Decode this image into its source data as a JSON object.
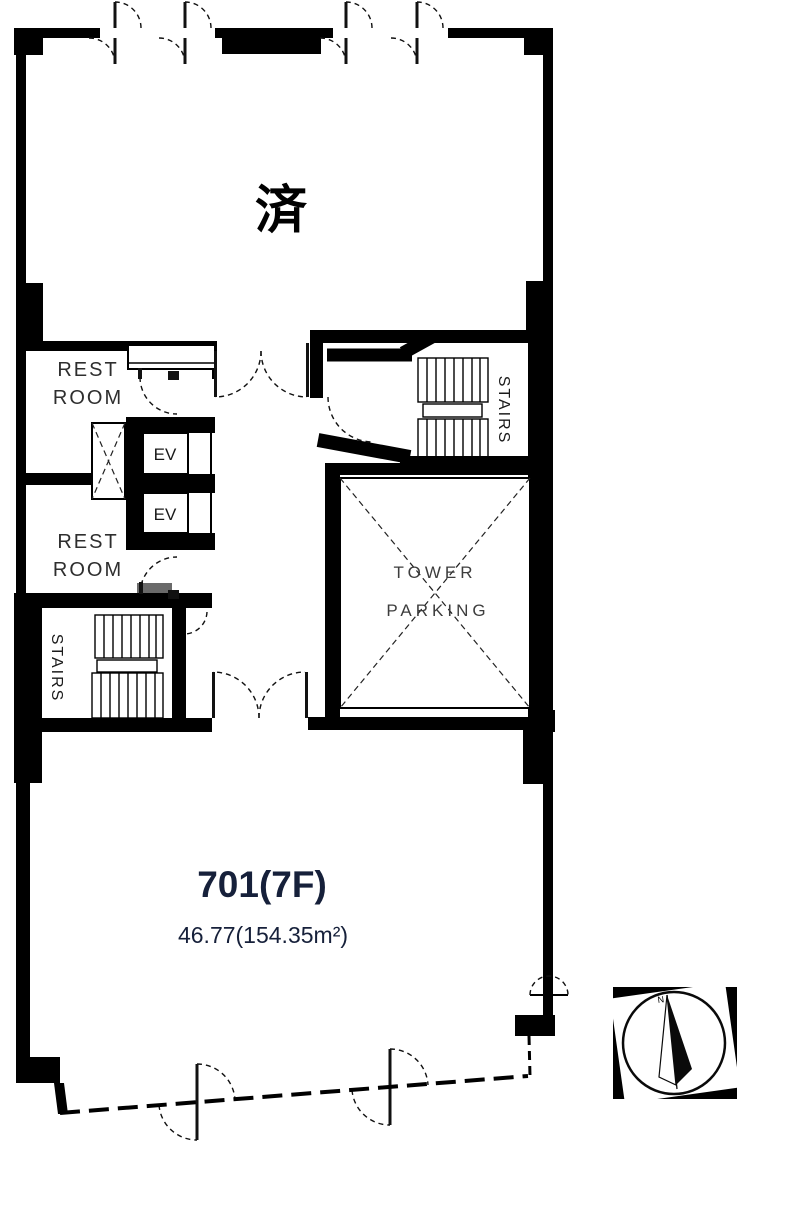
{
  "status": {
    "label": "済"
  },
  "unit": {
    "number": "701(7F)",
    "area": "46.77(154.35m²)"
  },
  "rooms": {
    "restroom_upper": {
      "line1": "REST",
      "line2": "ROOM"
    },
    "restroom_lower": {
      "line1": "REST",
      "line2": "ROOM"
    },
    "stairs_left": {
      "label": "STAIRS"
    },
    "stairs_right": {
      "label": "STAIRS"
    },
    "elevator_upper": {
      "label": "EV"
    },
    "elevator_lower": {
      "label": "EV"
    },
    "tower_parking": {
      "line1": "TOWER",
      "line2": "PARKING"
    }
  },
  "compass": {
    "north": "N"
  },
  "colors": {
    "wall": "#000000",
    "background": "#ffffff",
    "unit_text": "#16203a",
    "label_text": "#2e2e2e"
  }
}
